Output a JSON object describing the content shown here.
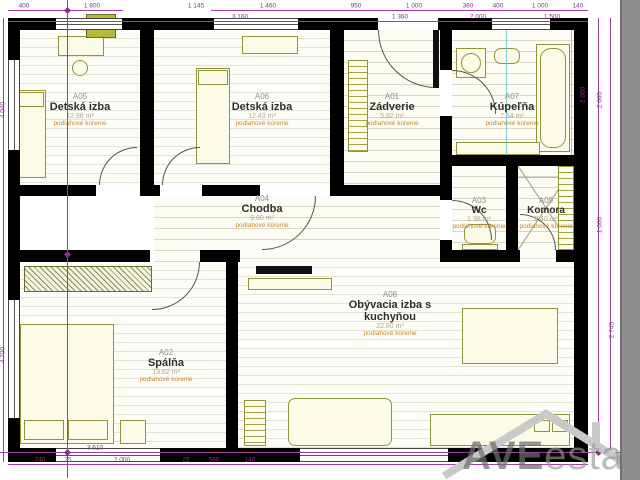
{
  "plan_title": "Apartment floor plan",
  "rooms": {
    "a05": {
      "code": "A05",
      "name": "Detská izba",
      "area": "12.98 m²",
      "note": "podlahové kúrenie"
    },
    "a06": {
      "code": "A06",
      "name": "Detská izba",
      "area": "12.43 m²",
      "note": "podlahové kúrenie"
    },
    "a01": {
      "code": "A01",
      "name": "Zádverie",
      "area": "5.82 m²",
      "note": "podlahové kúrenie"
    },
    "a07": {
      "code": "A07",
      "name": "Kúpeľňa",
      "area": "7.34 m²",
      "note": "podlahové kúrenie"
    },
    "a04": {
      "code": "A04",
      "name": "Chodba",
      "area": "9.80 m²",
      "note": "podlahové kúrenie"
    },
    "a03": {
      "code": "A03",
      "name": "Wc",
      "area": "1.98 m²",
      "note": "podlahové kúrenie"
    },
    "a09": {
      "code": "A09",
      "name": "Komora",
      "area": "2.40 m²",
      "note": "podlahové kúrenie"
    },
    "a02": {
      "code": "A02",
      "name": "Spálňa",
      "area": "13.62 m²",
      "note": "podlahové kúrenie"
    },
    "a08": {
      "code": "A08",
      "name": "Obývacia izba s kuchyňou",
      "area": "22.60 m²",
      "note": "podlahové kúrenie"
    }
  },
  "dimensions": {
    "top": [
      "400",
      "1 800",
      "1 145",
      "1 460",
      "950",
      "1 000",
      "360",
      "400",
      "1 000",
      "140",
      "3 160",
      "1 360",
      "2 000",
      "1 500"
    ],
    "bottom": [
      "3 610",
      "6 900",
      "740",
      "25",
      "2 000",
      "25",
      "580",
      "140"
    ],
    "left": [
      "4 040",
      "4 700"
    ],
    "right": [
      "2 660",
      "1 000",
      "2 745"
    ],
    "inner": [
      "2 080"
    ]
  },
  "watermark": {
    "brand_bold": "AVE",
    "brand_light": "estate"
  },
  "colors": {
    "wall": "#000000",
    "furniture": "#93933c",
    "dimension": "#8b2f8b",
    "heating_note": "#c8862e",
    "floor_line": "#e4e2d3",
    "glass": "#7ecfcf",
    "watermark": "#a0a0a0",
    "side_strip": "#8f8f8f"
  }
}
